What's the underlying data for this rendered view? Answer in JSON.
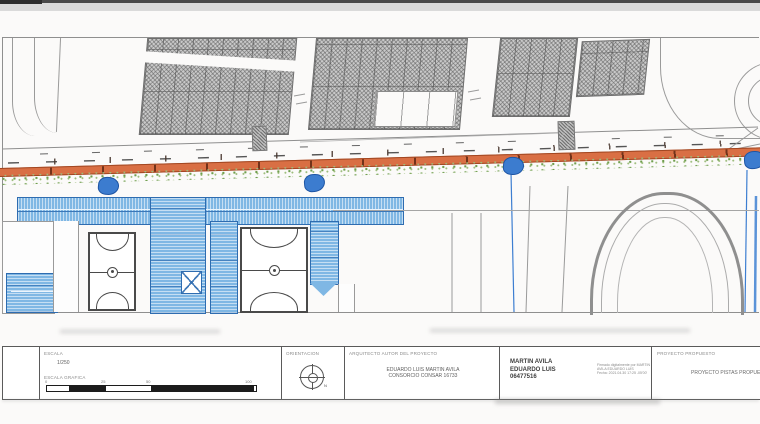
{
  "sheet": {
    "kind": "urban street improvement plan drawing"
  },
  "title_block": {
    "scale": {
      "label": "ESCALA",
      "value": "1/250",
      "graphic_label": "ESCALA GRAFICA",
      "ticks": [
        "0",
        "25",
        "50",
        "100"
      ]
    },
    "orientation": {
      "label": "ORIENTACION",
      "north_letter": "N"
    },
    "architect": {
      "label": "ARQUITECTO AUTOR DEL PROYECTO",
      "line1": "EDUARDO LUIS MARTIN AVILA",
      "line2": "CONSORCIO CONSAR 16733"
    },
    "signature": {
      "name_line1": "MARTIN AVILA",
      "name_line2": "EDUARDO LUIS",
      "name_line3": "06477516",
      "stamp_line1": "Firmado digitalmente por MARTIN",
      "stamp_line2": "AVILA EDUARDO LUIS",
      "stamp_line3": "Fecha: 2021.04.30 17:25 -05'00'"
    },
    "project": {
      "label": "PROYECTO PROPUESTO",
      "value": "PROYECTO PISTAS PROPUESTAS"
    }
  },
  "icons": {
    "north_compass": "north-compass-icon",
    "tree_marker": "tree-marker-icon"
  },
  "colors": {
    "sidewalk_orange": "#d96f44",
    "planting_green": "#6f9e4d",
    "roof_blue": "#7fb7e4",
    "tree_blue": "#3c7ccf",
    "hatch_gray": "#c9c9c9",
    "line_gray": "#8f8f8f"
  }
}
